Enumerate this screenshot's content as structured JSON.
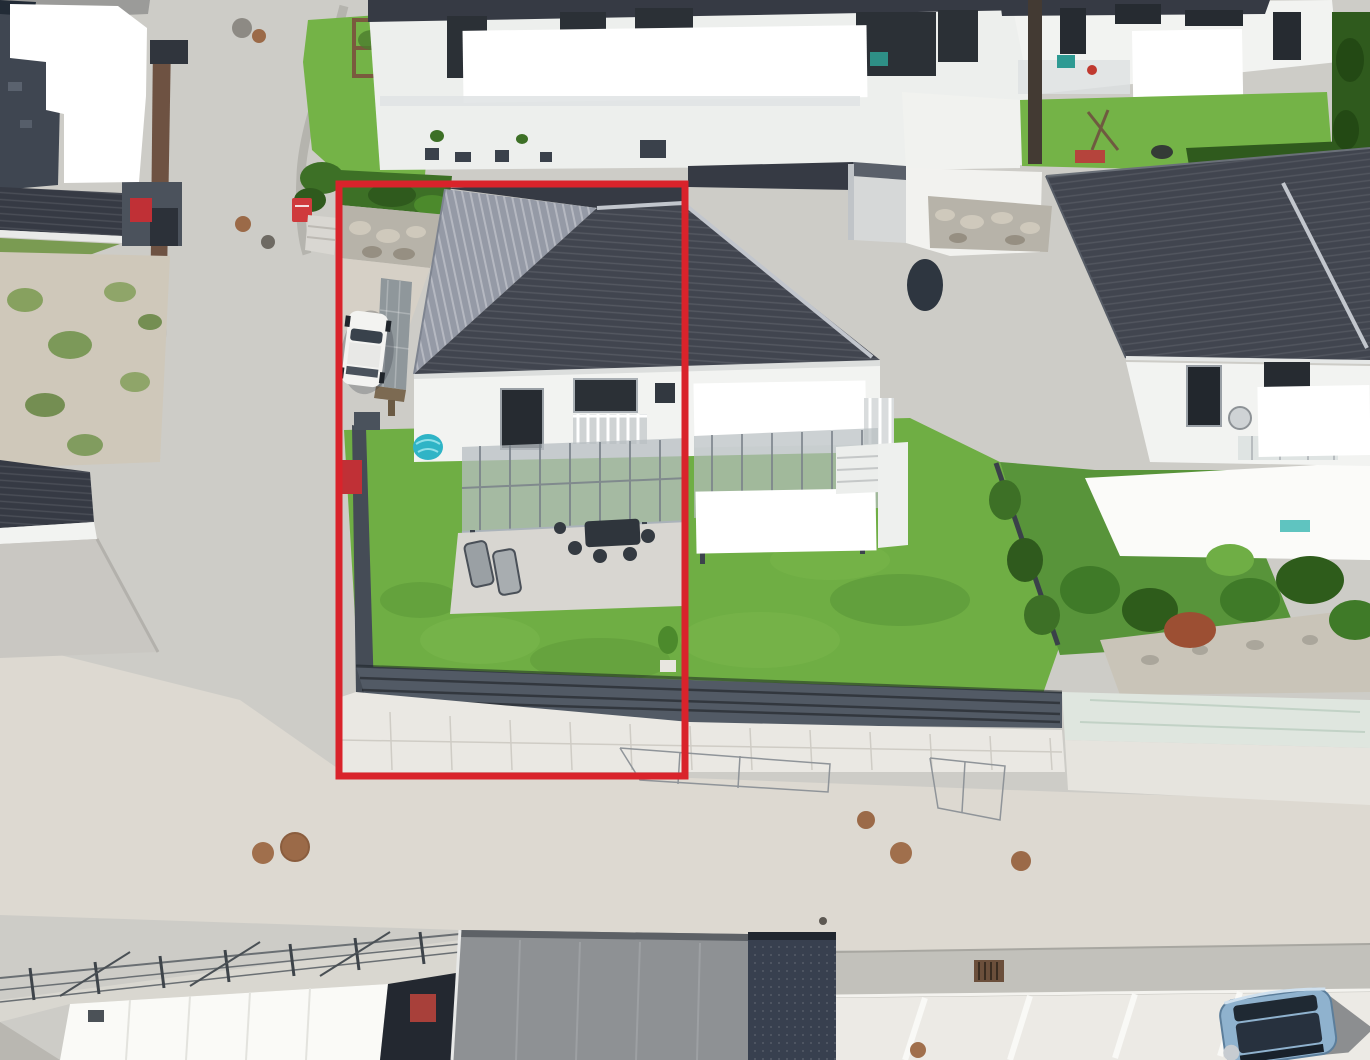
{
  "image": {
    "kind": "aerial drone photograph",
    "description": "Bird's-eye view of a residential street: a semi-detached hip-roof house with glass terrace canopy and fenced lawn is outlined by a red rectangle; neighboring bungalows, gardens, a street with manhole covers, a carport with a white car, a parked light-blue car and white privacy-redaction patches are visible."
  },
  "annotation": {
    "shape": "rectangle",
    "purpose": "red outline marking the corner property for sale",
    "color": "#d9232b"
  },
  "scene": {
    "objects": [
      "subject-house-hip-roof",
      "carport-with-white-car",
      "glass-terrace-canopy",
      "patio-furniture",
      "garden-lawn",
      "privacy-fence-on-block-wall",
      "kiddie-pool",
      "front-garden-with-play-frame",
      "red-mailbox",
      "neighbor-house-right",
      "neighbor-house-top",
      "neighbor-house-left",
      "street-with-manholes",
      "parking-bay-with-blue-car",
      "flat-garage-roof",
      "hedges-and-shrubs",
      "gravel-verge",
      "white-privacy-redactions"
    ]
  },
  "colors": {
    "road_base": "#cdccc7",
    "road_pale": "#ddd9d1",
    "asphalt_dark": "#9b9b99",
    "gravel": "#cfc8ba",
    "ramp": "#c9c7c2",
    "roof_dark": "#41454f",
    "roof_dark2": "#363a44",
    "roof_sunlit": "#959aa6",
    "ridge": "#c2c6cd",
    "white_wall": "#f2f3f1",
    "pure_white": "#ffffff",
    "glass": "#b7bdc1",
    "patio": "#d8d6d1",
    "grass_main": "#6fae44",
    "grass_right": "#58943a",
    "grass_front": "#74b347",
    "grass_strip": "#7a9b52",
    "hedge": "#2f5a1d",
    "bush": "#3d7026",
    "fence": "#454c56",
    "fence_slat": "#525a65",
    "wall_blocks": "#eae8e3",
    "tarp": "#dfe6df",
    "wood_fence": "#6e5242",
    "red_accent": "#d9232b",
    "red_bin": "#c03036",
    "mailbox_red": "#cf3a3c",
    "pool": "#2fb4c6",
    "car_white": "#f3f3f1",
    "car_glass": "#39424c",
    "car_blue": "#8fb2ce",
    "car_blue_top": "#27313e",
    "garage_roof": "#8e9194",
    "navy_roof": "#38404f",
    "pavers": "#eceae5",
    "gutter_strip": "#c2c1bb",
    "stone_curb": "#b5b4ae",
    "stone_wall": "#b7b3a9",
    "manhole": "#9b6a48",
    "white_roof": "#fafaf7",
    "dark_bldg": "#232830",
    "door_red": "#a8403a",
    "steps": "#d9d7d2",
    "carport_panel": "#8f979b"
  }
}
